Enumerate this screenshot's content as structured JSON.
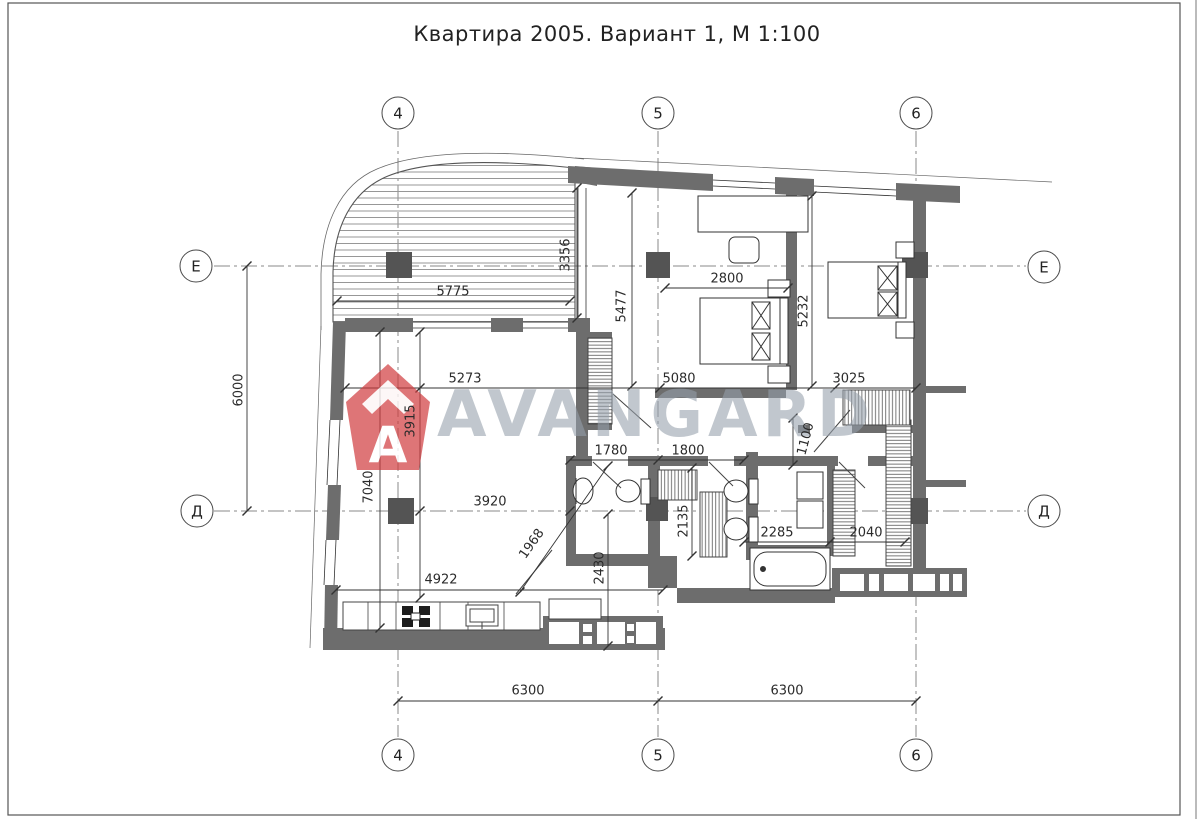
{
  "title": "Квартира 2005. Вариант 1, М 1:100",
  "watermark": {
    "text": "AVANGARD",
    "logo_letter": "A"
  },
  "axes": {
    "bubbles": [
      {
        "label": "4",
        "x": 398,
        "y": 113
      },
      {
        "label": "5",
        "x": 658,
        "y": 113
      },
      {
        "label": "6",
        "x": 916,
        "y": 113
      },
      {
        "label": "4",
        "x": 398,
        "y": 755
      },
      {
        "label": "5",
        "x": 658,
        "y": 755
      },
      {
        "label": "6",
        "x": 916,
        "y": 755
      },
      {
        "label": "Е",
        "x": 196,
        "y": 266
      },
      {
        "label": "Д",
        "x": 197,
        "y": 511
      },
      {
        "label": "Е",
        "x": 1044,
        "y": 267
      },
      {
        "label": "Д",
        "x": 1044,
        "y": 511
      }
    ]
  },
  "dimensions": [
    {
      "value": "5775",
      "x": 453,
      "y": 292,
      "rot": 0
    },
    {
      "value": "3356",
      "x": 566,
      "y": 255,
      "rot": -90
    },
    {
      "value": "2800",
      "x": 727,
      "y": 279,
      "rot": 0
    },
    {
      "value": "5477",
      "x": 622,
      "y": 306,
      "rot": -90
    },
    {
      "value": "5232",
      "x": 804,
      "y": 311,
      "rot": -90
    },
    {
      "value": "6000",
      "x": 239,
      "y": 390,
      "rot": -90
    },
    {
      "value": "5273",
      "x": 465,
      "y": 379,
      "rot": 0
    },
    {
      "value": "5080",
      "x": 679,
      "y": 379,
      "rot": 0
    },
    {
      "value": "3025",
      "x": 849,
      "y": 379,
      "rot": 0
    },
    {
      "value": "3915",
      "x": 411,
      "y": 421,
      "rot": -90
    },
    {
      "value": "7040",
      "x": 369,
      "y": 487,
      "rot": -90
    },
    {
      "value": "1780",
      "x": 611,
      "y": 451,
      "rot": 0
    },
    {
      "value": "1800",
      "x": 688,
      "y": 451,
      "rot": 0
    },
    {
      "value": "1100",
      "x": 806,
      "y": 439,
      "rot": -75
    },
    {
      "value": "3920",
      "x": 490,
      "y": 502,
      "rot": 0
    },
    {
      "value": "2135",
      "x": 684,
      "y": 521,
      "rot": -90
    },
    {
      "value": "2285",
      "x": 777,
      "y": 533,
      "rot": 0
    },
    {
      "value": "2040",
      "x": 866,
      "y": 533,
      "rot": 0
    },
    {
      "value": "1968",
      "x": 532,
      "y": 544,
      "rot": -55
    },
    {
      "value": "2430",
      "x": 600,
      "y": 568,
      "rot": -90
    },
    {
      "value": "4922",
      "x": 441,
      "y": 580,
      "rot": 0
    },
    {
      "value": "6300",
      "x": 528,
      "y": 691,
      "rot": 0
    },
    {
      "value": "6300",
      "x": 787,
      "y": 691,
      "rot": 0
    }
  ],
  "colors": {
    "wall": "#6d6d6d",
    "column": "#545454",
    "line": "#333333",
    "axis": "#8a8a8a",
    "dimText": "#2b2b2b",
    "wmText": "#96a0ab",
    "wmLogo": "#cf3a3c"
  }
}
